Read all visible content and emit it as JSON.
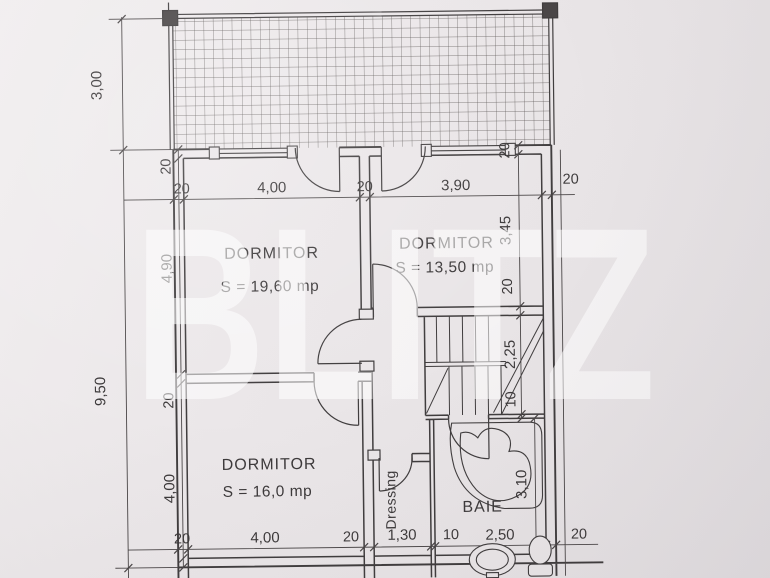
{
  "watermark": "BLITZ",
  "rooms": {
    "dormitor1": {
      "name": "DORMITOR",
      "area": "S = 19,60 mp"
    },
    "dormitor2": {
      "name": "DORMITOR",
      "area": "S = 13,50 mp"
    },
    "dormitor3": {
      "name": "DORMITOR",
      "area": "S = 16,0 mp"
    },
    "baie": {
      "name": "BAIE"
    },
    "dressing": {
      "name": "Dressing"
    }
  },
  "dims": {
    "left_outer": {
      "terrace": "3,00",
      "total": "9,50"
    },
    "left_inner": [
      "20",
      "4,90",
      "20",
      "4,00"
    ],
    "top": [
      "20",
      "4,00",
      "20",
      "3,90",
      "20"
    ],
    "right_inner": [
      "20",
      "3,45",
      "20",
      "2,25",
      "10"
    ],
    "baie_vertical": "3,10",
    "bottom": [
      "20",
      "4,00",
      "20",
      "1,30",
      "10",
      "2,50",
      "20"
    ]
  },
  "colors": {
    "paper": "#eae6e8",
    "line": "#403d3e",
    "dim_line": "#4a4647",
    "text": "#3d3a3b",
    "watermark": "#ffffff"
  }
}
